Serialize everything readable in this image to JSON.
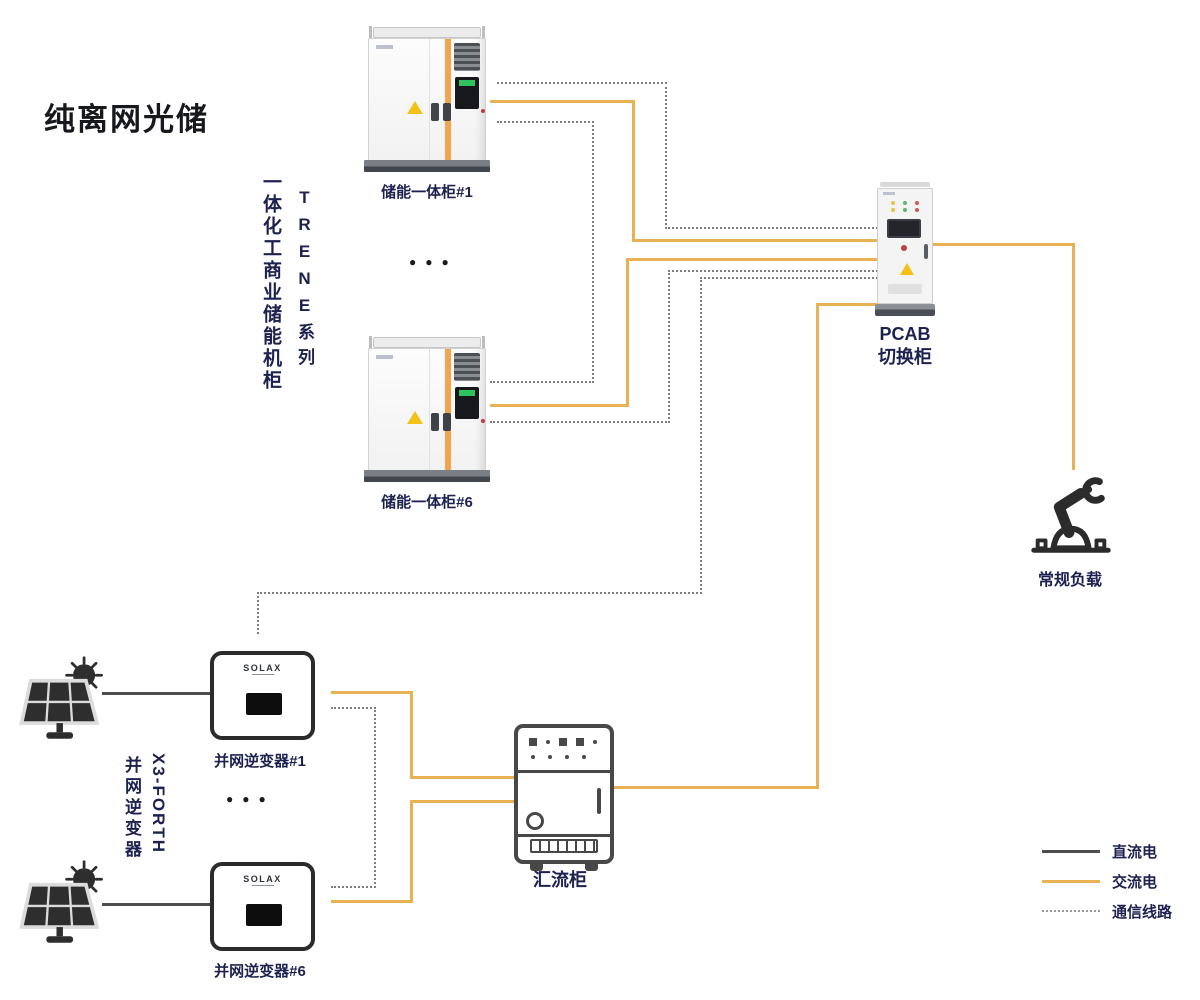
{
  "title": "纯离网光储",
  "colors": {
    "ac": "#e8b152",
    "dc": "#4d4d4d",
    "comm": "#7d7d7d",
    "orange": "#f2a44e",
    "navy": "#1c2150",
    "warning": "#f3c117"
  },
  "storage": {
    "type_vertical": "一体化工商业储能机柜",
    "series_vertical": "TRENE系列",
    "cabinet1_label": "储能一体柜#1",
    "cabinet6_label": "储能一体柜#6",
    "ellipsis": "●●●"
  },
  "pv": {
    "model_vertical": "X3-FORTH",
    "type_vertical": "并网逆变器",
    "inverter1_label": "并网逆变器#1",
    "inverter6_label": "并网逆变器#6",
    "brand": "SOLAX",
    "ellipsis": "●●●"
  },
  "pcab": {
    "label_line1": "PCAB",
    "label_line2": "切换柜"
  },
  "load": {
    "label": "常规负载"
  },
  "combiner": {
    "label": "汇流柜"
  },
  "legend": {
    "items": [
      {
        "id": "dc",
        "label": "直流电"
      },
      {
        "id": "ac",
        "label": "交流电"
      },
      {
        "id": "comm",
        "label": "通信线路"
      }
    ]
  }
}
